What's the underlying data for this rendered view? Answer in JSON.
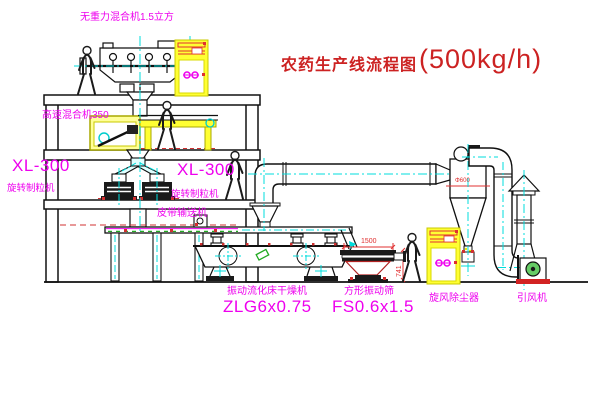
{
  "title": {
    "text": "农药生产线流程图",
    "capacity": "(500kg/h)"
  },
  "equipment_labels": {
    "gravity_mixer": "无重力混合机1.5立方",
    "high_speed_mixer": "高速混合机350",
    "granulator_left_model": "XL-300",
    "granulator_left_name": "旋转制粒机",
    "granulator_right_model": "XL-300",
    "granulator_right_name": "旋转制粒机",
    "belt_conveyor": "皮带输送机",
    "fluid_bed_dryer_name": "振动流化床干燥机",
    "fluid_bed_dryer_model": "ZLG6x0.75",
    "vibrating_screen_name": "方形振动筛",
    "vibrating_screen_model": "FS0.6x1.5",
    "cyclone_dust_collector": "旋风除尘器",
    "induced_draft_fan": "引风机"
  },
  "dimensions": {
    "screen_length": "1500",
    "screen_height": "741",
    "cyclone_diameter": "Φ600"
  },
  "colors": {
    "label_magenta": "#EE00EE",
    "title_red": "#CC2222",
    "centerline_cyan": "#00DCDC",
    "cabinet_yellow": "#FFFF33",
    "dimension_red": "#E03030",
    "motor_green": "#66CC66"
  }
}
